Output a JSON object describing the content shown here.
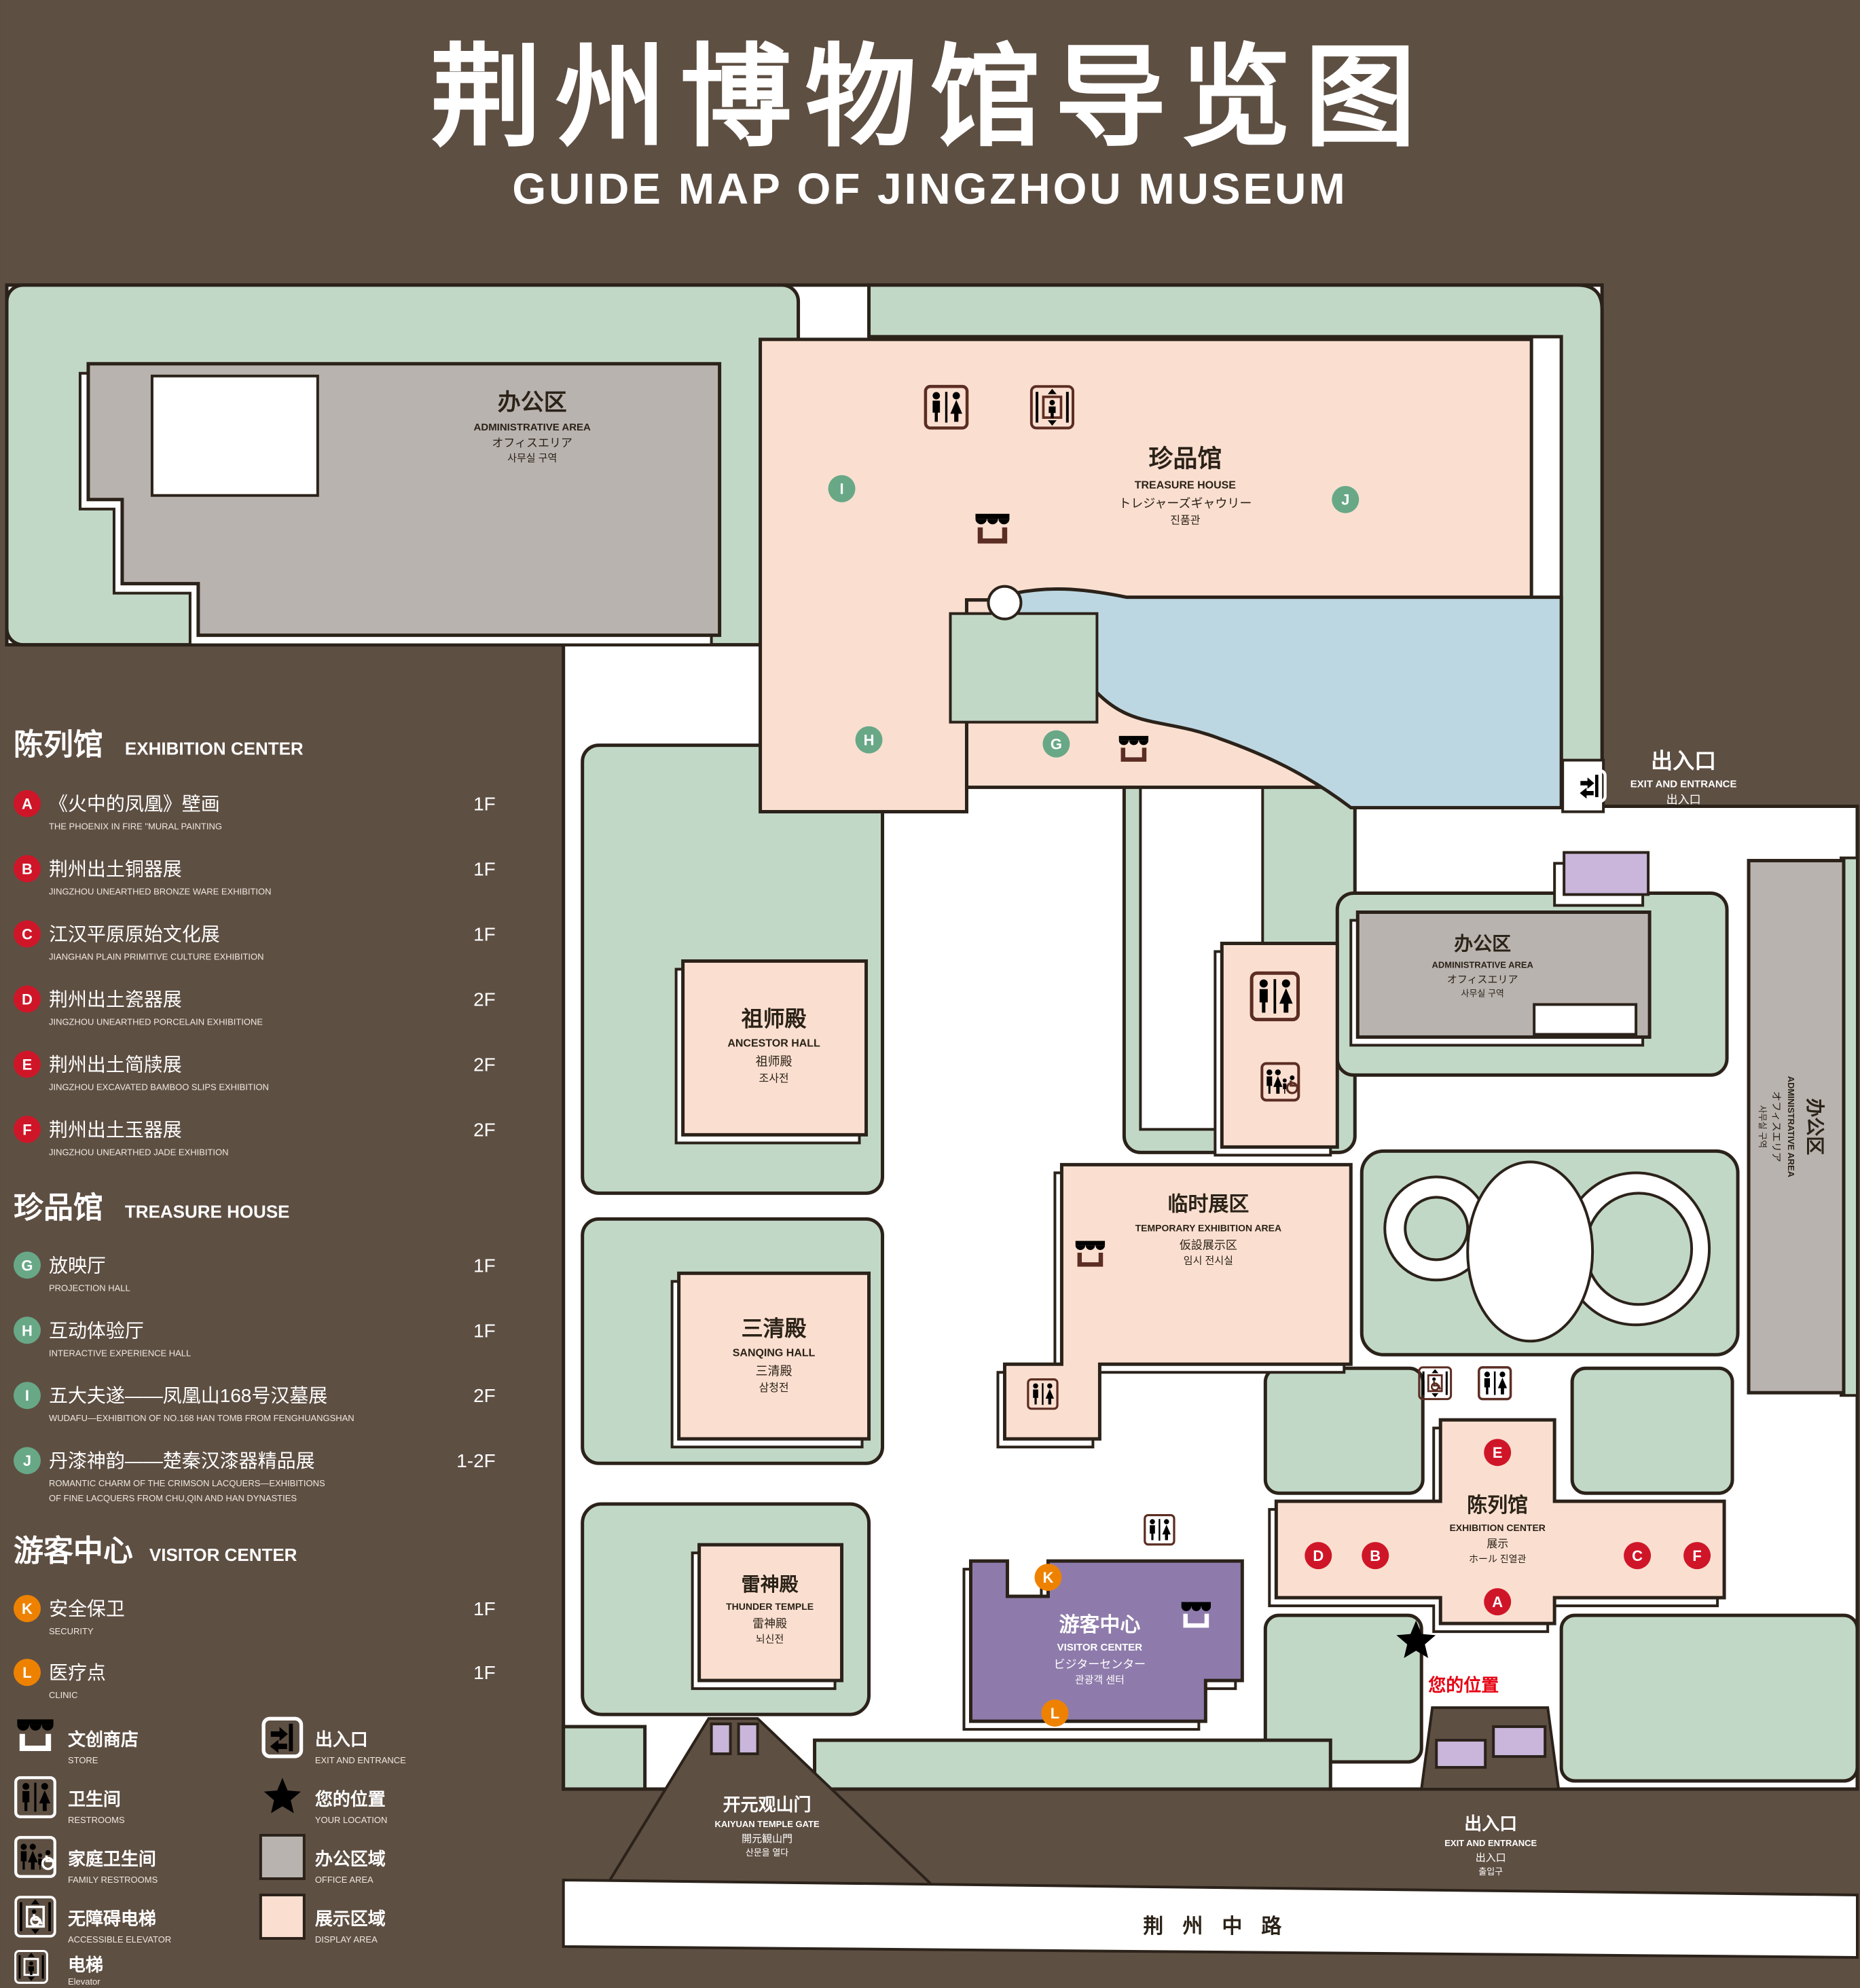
{
  "title": {
    "zh": "荆州博物馆导览图",
    "en": "GUIDE MAP OF JINGZHOU MUSEUM"
  },
  "legend": {
    "sections": [
      {
        "zh": "陈列馆",
        "en": "EXHIBITION CENTER",
        "items": [
          {
            "key": "A",
            "zh": "《火中的凤凰》壁画",
            "en": "THE PHOENIX IN FIRE \"MURAL PAINTING",
            "floor": "1F"
          },
          {
            "key": "B",
            "zh": "荆州出土铜器展",
            "en": "JINGZHOU UNEARTHED BRONZE WARE EXHIBITION",
            "floor": "1F"
          },
          {
            "key": "C",
            "zh": "江汉平原原始文化展",
            "en": "JIANGHAN PLAIN PRIMITIVE CULTURE EXHIBITION",
            "floor": "1F"
          },
          {
            "key": "D",
            "zh": "荆州出土瓷器展",
            "en": "JINGZHOU UNEARTHED PORCELAIN EXHIBITIONE",
            "floor": "2F"
          },
          {
            "key": "E",
            "zh": "荆州出土简牍展",
            "en": "JINGZHOU EXCAVATED BAMBOO SLIPS EXHIBITION",
            "floor": "2F"
          },
          {
            "key": "F",
            "zh": "荆州出土玉器展",
            "en": "JINGZHOU UNEARTHED JADE EXHIBITION",
            "floor": "2F"
          }
        ]
      },
      {
        "zh": "珍品馆",
        "en": "TREASURE HOUSE",
        "items": [
          {
            "key": "G",
            "zh": "放映厅",
            "en": "PROJECTION HALL",
            "floor": "1F"
          },
          {
            "key": "H",
            "zh": "互动体验厅",
            "en": "INTERACTIVE EXPERIENCE HALL",
            "floor": "1F"
          },
          {
            "key": "I",
            "zh": "五大夫遂——凤凰山168号汉墓展",
            "en": "WUDAFU—EXHIBITION OF NO.168 HAN TOMB FROM FENGHUANGSHAN",
            "floor": "2F"
          },
          {
            "key": "J",
            "zh": "丹漆神韵——楚秦汉漆器精品展",
            "en": "ROMANTIC CHARM OF THE CRIMSON LACQUERS—EXHIBITIONS",
            "en2": "OF FINE LACQUERS FROM CHU,QIN AND HAN DYNASTIES",
            "floor": "1-2F"
          }
        ]
      },
      {
        "zh": "游客中心",
        "en": "VISITOR CENTER",
        "items": [
          {
            "key": "K",
            "zh": "安全保卫",
            "en": "SECURITY",
            "floor": "1F"
          },
          {
            "key": "L",
            "zh": "医疗点",
            "en": "CLINIC",
            "floor": "1F"
          }
        ]
      }
    ],
    "icons": [
      {
        "zh": "文创商店",
        "en": "STORE"
      },
      {
        "zh": "出入口",
        "en": "EXIT AND ENTRANCE"
      },
      {
        "zh": "卫生间",
        "en": "RESTROOMS"
      },
      {
        "zh": "您的位置",
        "en": "YOUR LOCATION"
      },
      {
        "zh": "家庭卫生间",
        "en": "FAMILY RESTROOMS"
      },
      {
        "zh": "办公区域",
        "en": "OFFICE AREA"
      },
      {
        "zh": "无障碍电梯",
        "en": "ACCESSIBLE ELEVATOR"
      },
      {
        "zh": "展示区域",
        "en": "DISPLAY AREA"
      },
      {
        "zh": "电梯",
        "en": "Elevator"
      }
    ]
  },
  "map": {
    "admin": {
      "zh": "办公区",
      "en": "ADMINISTRATIVE AREA",
      "ja": "オフィスエリア",
      "ko": "사무실 구역"
    },
    "treasure": {
      "zh": "珍品馆",
      "en": "TREASURE HOUSE",
      "ja": "トレジャーズギャウリー",
      "ko": "진품관"
    },
    "ancestor": {
      "zh": "祖师殿",
      "en": "ANCESTOR HALL",
      "ja": "祖师殿",
      "ko": "조사전"
    },
    "temporary": {
      "zh": "临时展区",
      "en": "TEMPORARY EXHIBITION AREA",
      "ja": "仮設展示区",
      "ko": "임시 전시실"
    },
    "sanqing": {
      "zh": "三清殿",
      "en": "SANQING HALL",
      "ja": "三清殿",
      "ko": "삼청전"
    },
    "thunder": {
      "zh": "雷神殿",
      "en": "THUNDER TEMPLE",
      "ja": "雷神殿",
      "ko": "뇌신전"
    },
    "visitor": {
      "zh": "游客中心",
      "en": "VISITOR CENTER",
      "ja": "ビジターセンター",
      "ko": "관광객 센터"
    },
    "exhibition": {
      "zh": "陈列馆",
      "en": "EXHIBITION CENTER",
      "ja": "展示",
      "ko": "ホール 진열관"
    },
    "exit": {
      "zh": "出入口",
      "en": "EXIT AND ENTRANCE",
      "ja": "出入口",
      "ko": "출입구"
    },
    "gate": {
      "zh": "开元观山门",
      "en": "KAIYUAN TEMPLE GATE",
      "ja": "開元観山門",
      "ko": "산문을 열다"
    },
    "road": "荆州中路",
    "your_location": "您的位置",
    "markers": {
      "A": "A",
      "B": "B",
      "C": "C",
      "D": "D",
      "E": "E",
      "F": "F",
      "G": "G",
      "H": "H",
      "I": "I",
      "J": "J",
      "K": "K",
      "L": "L"
    }
  },
  "colors": {
    "background": "#5e4f43",
    "green": "#c2d8c7",
    "display_area": "#fadfd0",
    "office_area": "#b9b3af",
    "water": "#bdd7e2",
    "visitor_center": "#8e7bab",
    "gate_purple": "#c9b6da",
    "marker_red": "#cf1628",
    "marker_green": "#68a887",
    "marker_orange": "#ee8200",
    "star_red": "#e60012",
    "icon_brown": "#5c2d22",
    "outline": "#2b221a"
  }
}
